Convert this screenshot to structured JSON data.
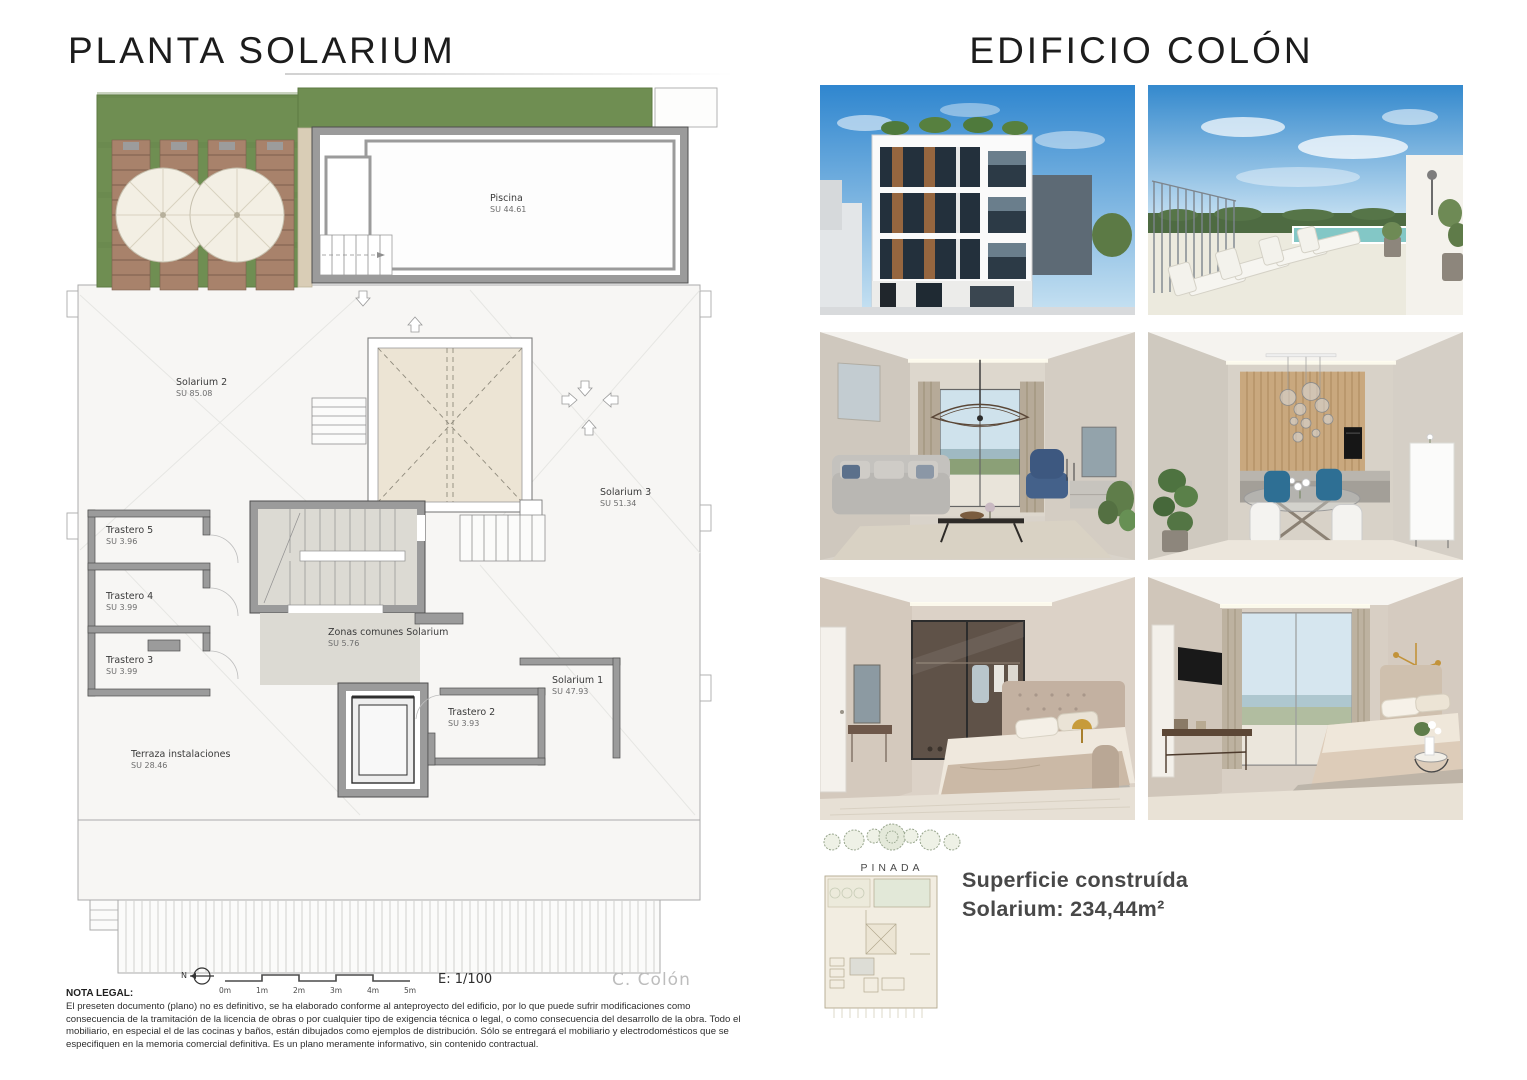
{
  "page": {
    "left_title": "PLANTA SOLARIUM",
    "right_title": "EDIFICIO COLÓN"
  },
  "plan": {
    "rooms": [
      {
        "name": "Piscina",
        "su": "SU 44.61"
      },
      {
        "name": "Solarium 2",
        "su": "SU 85.08"
      },
      {
        "name": "Solarium 3",
        "su": "SU 51.34"
      },
      {
        "name": "Trastero 5",
        "su": "SU 3.96"
      },
      {
        "name": "Trastero 4",
        "su": "SU 3.99"
      },
      {
        "name": "Trastero 3",
        "su": "SU 3.99"
      },
      {
        "name": "Zonas comunes Solarium",
        "su": "SU 5.76"
      },
      {
        "name": "Solarium 1",
        "su": "SU 47.93"
      },
      {
        "name": "Trastero 2",
        "su": "SU 3.93"
      },
      {
        "name": "Terraza instalaciones",
        "su": "SU 28.46"
      }
    ],
    "scale_bar": {
      "north": "N",
      "ticks": [
        "0m",
        "1m",
        "2m",
        "3m",
        "4m",
        "5m"
      ],
      "ratio": "E: 1/100"
    },
    "author": "C. Colón",
    "colors": {
      "lawn": "#6f8e52",
      "wall_gray": "#9b9b9b",
      "skylight_fill": "#ece4d4",
      "deck_wood": "#a8826b"
    }
  },
  "gallery": {
    "subjects": [
      "building-facade-render",
      "rooftop-pool-terrace-render",
      "living-room-render",
      "dining-kitchen-render",
      "bedroom-dressing-render",
      "bedroom-views-render"
    ]
  },
  "brand": {
    "name": "PINADA"
  },
  "summary": {
    "line1": "Superficie construída",
    "line2": "Solarium: 234,44m²"
  },
  "legal": {
    "title": "NOTA LEGAL:",
    "body": "El preseten documento (plano) no es definitivo, se ha elaborado conforme al anteproyecto del edificio, por lo que puede sufrir modificaciones como consecuencia de la tramitación de la licencia de obras o por cualquier tipo de exigencia técnica o legal, o como consecuencia del desarrollo de la obra. Todo el mobiliario, en especial el de las cocinas y baños, están dibujados como ejemplos de distribución. Sólo se entregará el mobiliario y electrodomésticos que se especifiquen en la memoria comercial definitiva. Es un plano meramente informativo, sin contenido contractual."
  }
}
